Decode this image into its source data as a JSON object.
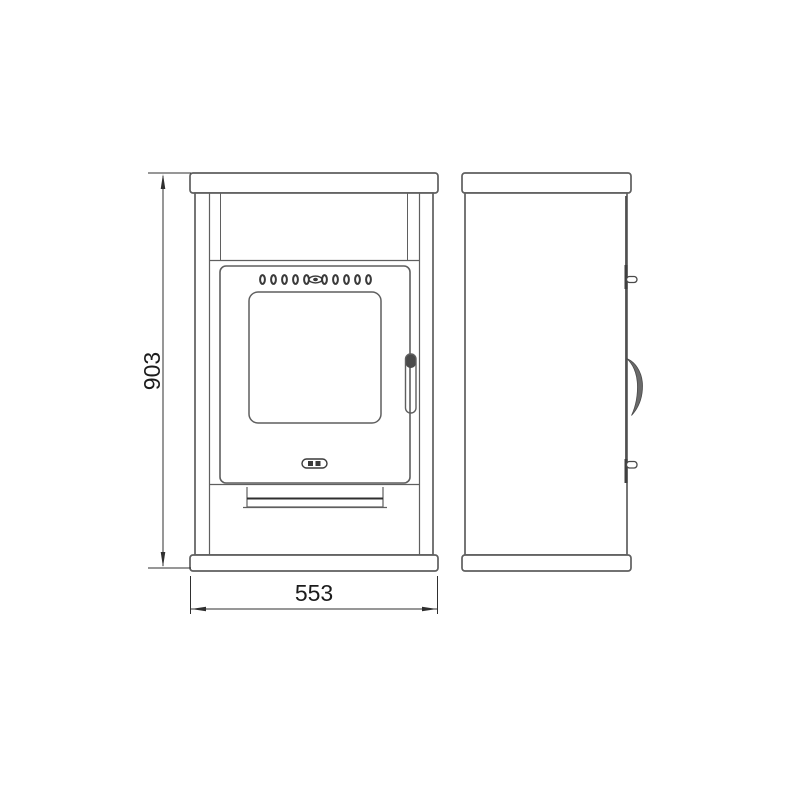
{
  "drawing": {
    "type": "technical-drawing-stove-two-views",
    "dimensions": {
      "height": "903",
      "width": "553"
    },
    "colors": {
      "line": "#5f5f5f",
      "dark_line": "#3a3a3a",
      "dimension_line": "#2f2f2f",
      "text": "#1c1c1c",
      "background": "#ffffff"
    }
  }
}
